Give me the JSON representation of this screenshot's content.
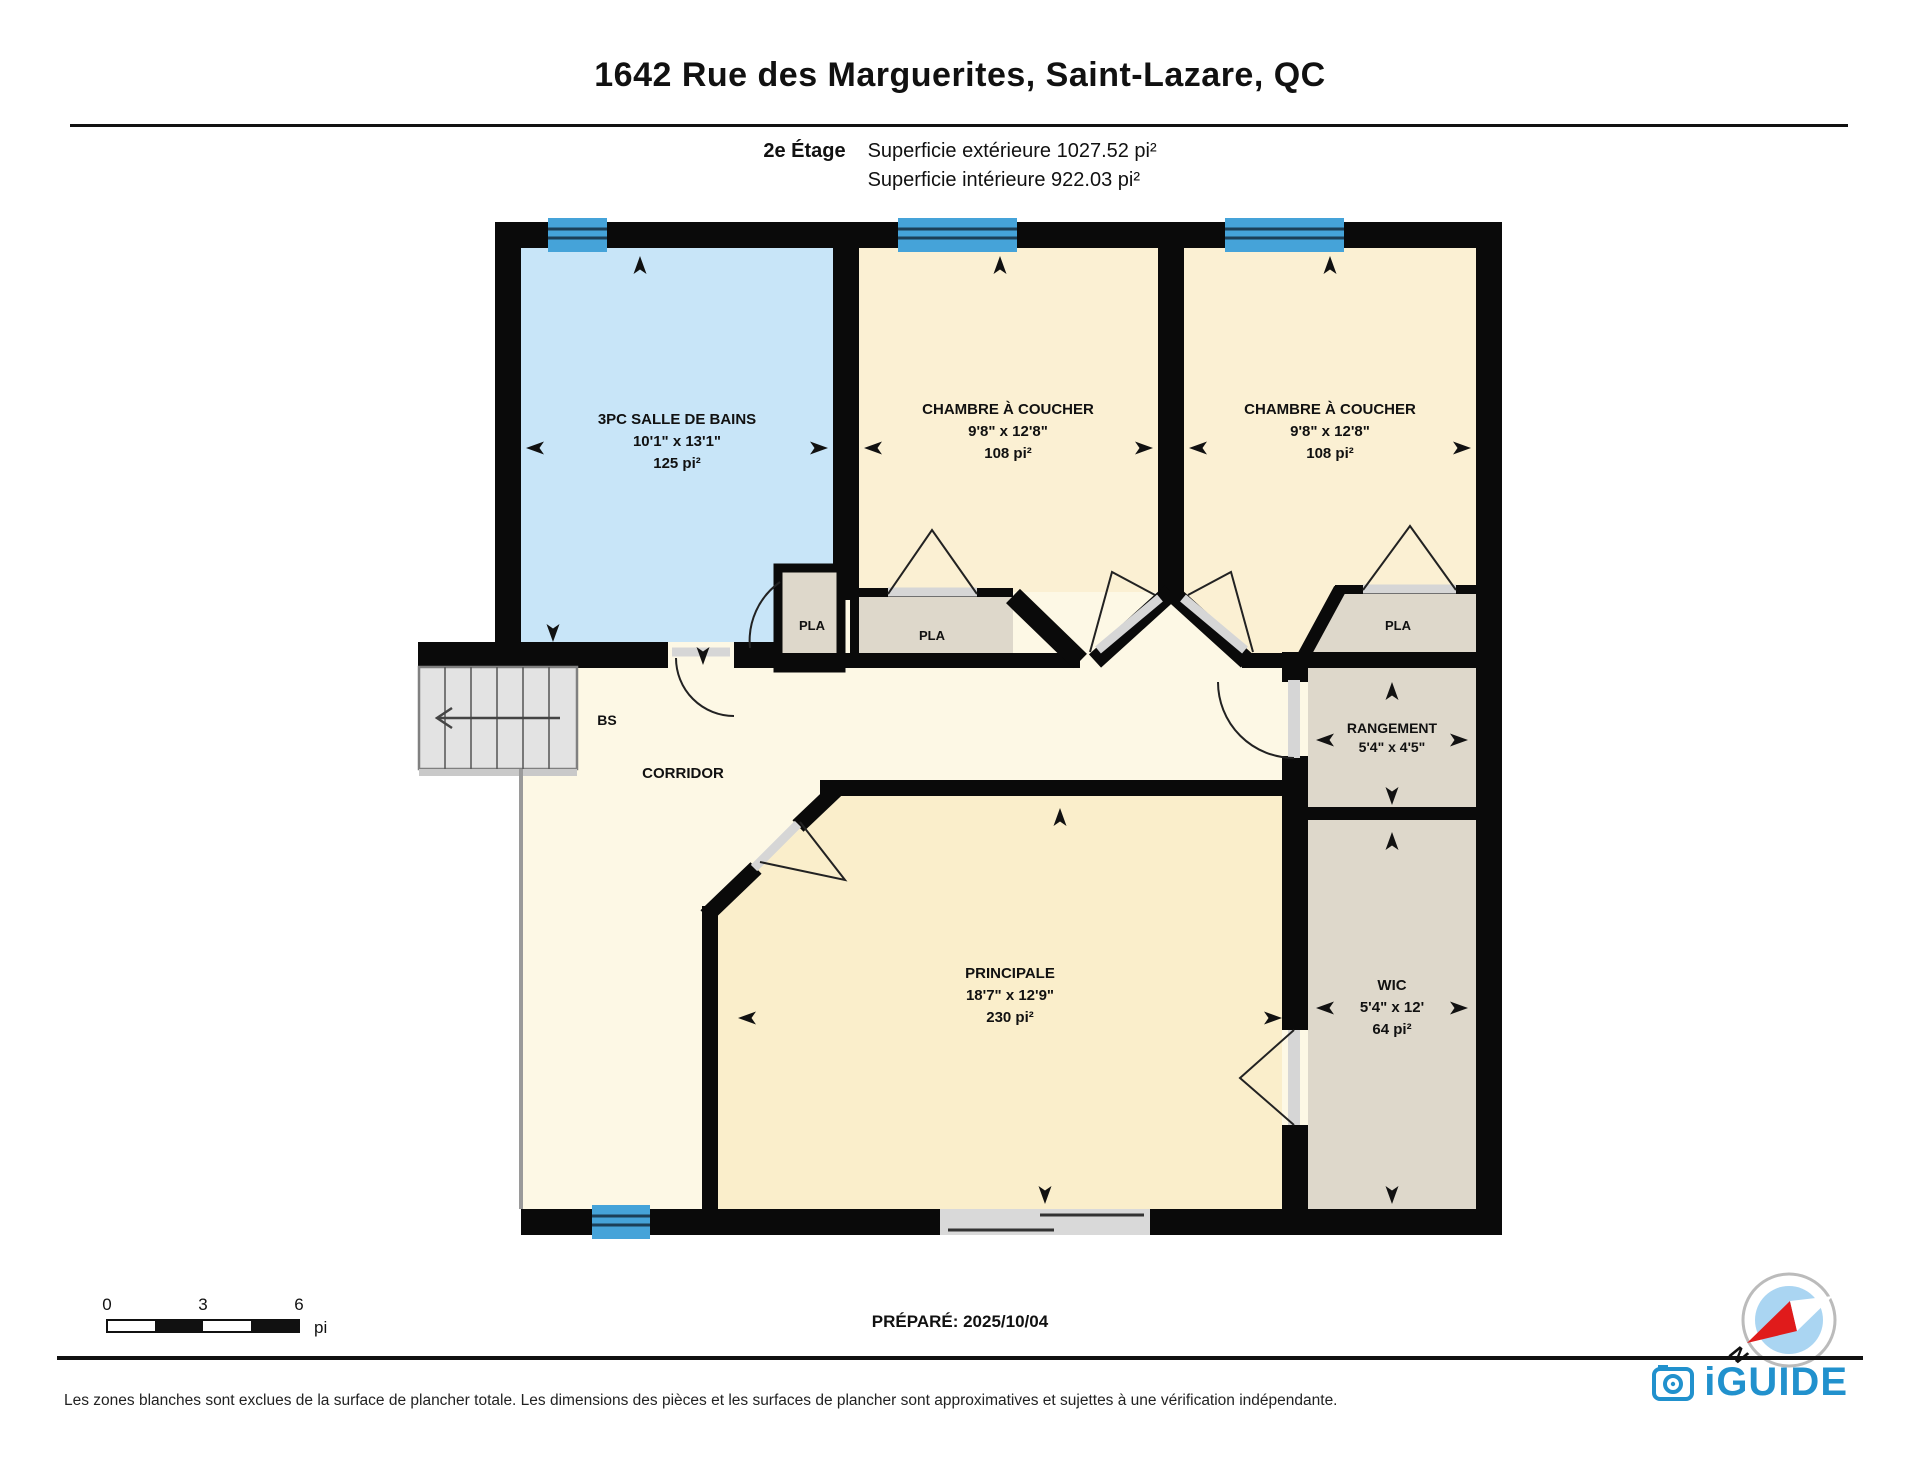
{
  "header": {
    "title": "1642 Rue des Marguerites, Saint-Lazare, QC",
    "floor_label": "2e Étage",
    "exterior_area": "Superficie extérieure 1027.52 pi²",
    "interior_area": "Superficie intérieure 922.03 pi²"
  },
  "rooms": {
    "bathroom": {
      "name": "3PC SALLE DE BAINS",
      "dims": "10'1\" x 13'1\"",
      "area": "125 pi²"
    },
    "bedroom1": {
      "name": "CHAMBRE À COUCHER",
      "dims": "9'8\" x 12'8\"",
      "area": "108 pi²"
    },
    "bedroom2": {
      "name": "CHAMBRE À COUCHER",
      "dims": "9'8\" x 12'8\"",
      "area": "108 pi²"
    },
    "principale": {
      "name": "PRINCIPALE",
      "dims": "18'7\" x 12'9\"",
      "area": "230 pi²"
    },
    "rangement": {
      "name": "RANGEMENT",
      "dims": "5'4\" x 4'5\""
    },
    "wic": {
      "name": "WIC",
      "dims": "5'4\" x 12'",
      "area": "64 pi²"
    },
    "corridor": {
      "name": "CORRIDOR"
    },
    "stairs": {
      "name": "BS"
    },
    "closet1": {
      "name": "PLA"
    },
    "closet2": {
      "name": "PLA"
    },
    "closet3": {
      "name": "PLA"
    }
  },
  "scale_bar": {
    "tick0": "0",
    "tick1": "3",
    "tick2": "6",
    "unit": "pi"
  },
  "prepared": "PRÉPARÉ: 2025/10/04",
  "compass": {
    "north_label": "N"
  },
  "footer": {
    "disclaimer": "Les zones blanches sont exclues de la surface de plancher totale. Les dimensions des pièces et les surfaces de plancher sont approximatives et sujettes à une vérification indépendante.",
    "brand": "iGUIDE"
  },
  "colors": {
    "wall": "#0a0a0a",
    "bathroom_fill": "#c8e5f8",
    "bedroom_fill": "#fbf0d3",
    "principale_fill": "#faeecb",
    "corridor_fill": "#fdf8e5",
    "closet_fill": "#ded8cb",
    "window_blue": "#45a3d9",
    "stairs_gray": "#e3e3e3",
    "brand_blue": "#2191cd",
    "compass_red": "#e01b1b",
    "compass_blue": "#aad5f2"
  }
}
